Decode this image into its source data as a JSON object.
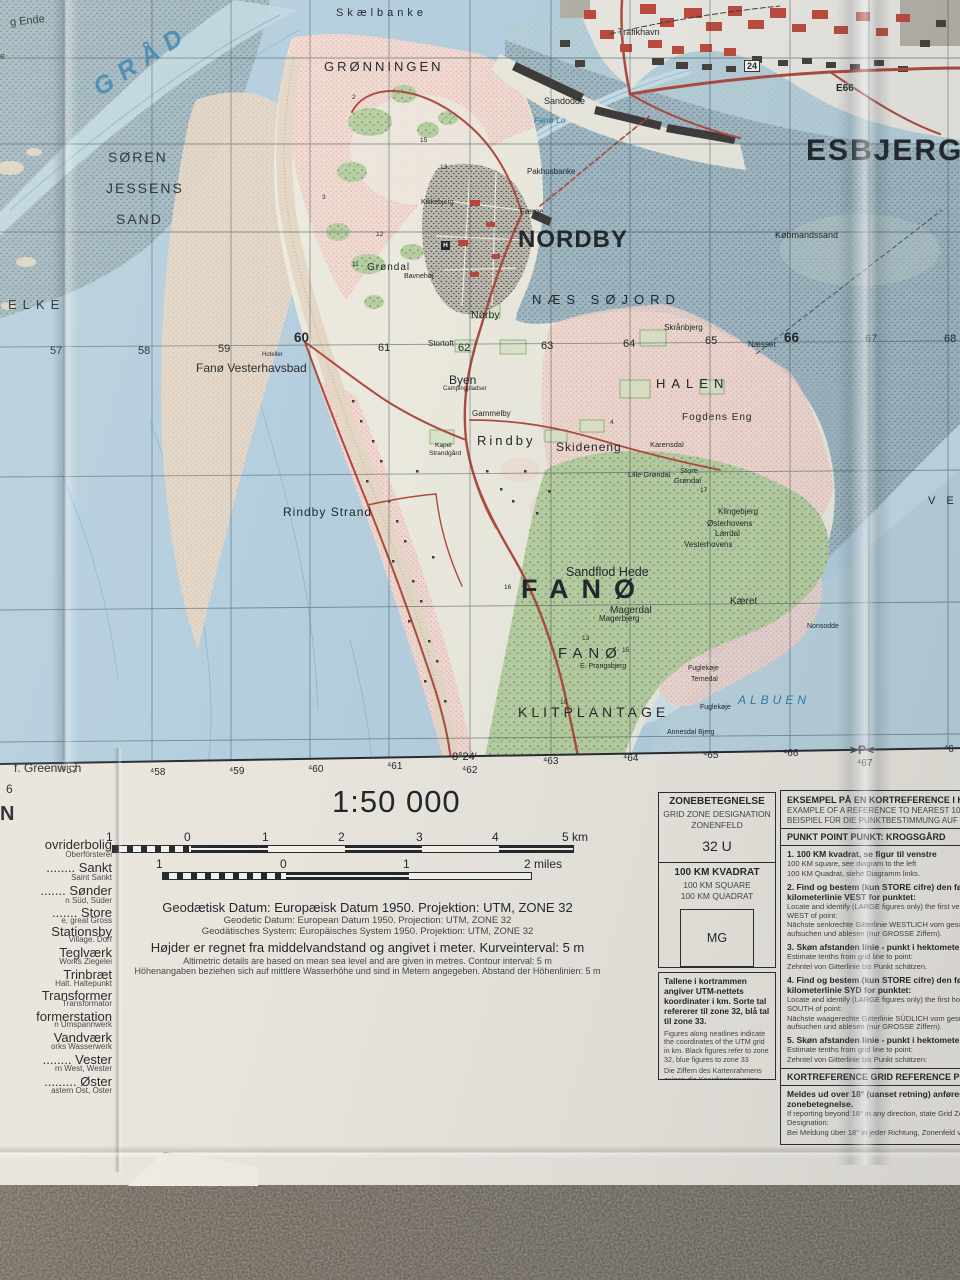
{
  "map_labels": {
    "g_ende": "g Ende",
    "e_frag": "e",
    "graadyb": "GRÅD",
    "skaelbanke": "Skælbanke",
    "groenningen": "GRØNNINGEN",
    "soeren": "SØREN",
    "jessens": "JESSENS",
    "sand": "SAND",
    "esbjerg": "ESBJERG",
    "trafikhavn": "Trafikhavn",
    "sandodde": "Sandodde",
    "fanoe_lo": "Fanø Lo",
    "pakhusbanke": "Pakhusbanke",
    "faerge": "Færge",
    "e66": "E66",
    "road24": "24",
    "koebmandssand": "Købmandssand",
    "nordby": "NORDBY",
    "naes_soejord": "NÆS SØJORD",
    "elke": "ELKE",
    "fanoe_vesterhavsbad": "Fanø Vesterhavsbad",
    "hoteller": "Hoteller",
    "skraanbjerg": "Skrånbjerg",
    "naesset": "Næsset",
    "halen": "HALEN",
    "fogdens_eng": "Fogdens Eng",
    "byen": "Byen",
    "stortoft": "Stortoft",
    "campingpladser": "Campingpladser",
    "gammelby": "Gammelby",
    "rindby": "Rindby",
    "skideneng": "Skideneng",
    "karensdal": "Karensdal",
    "lille_groendal": "Lille Grøndal",
    "store_groendal_1": "Store",
    "store_groendal_2": "Grøndal",
    "groendal": "Grøndal",
    "bavnehoej": "Bavnehøj",
    "kikkebjerg": "Kikkebjerg",
    "noerby": "Nørby",
    "kapel": "Kapel",
    "strandgaard": "Strandgård",
    "rindby_strand": "Rindby Strand",
    "klingebjerg": "Klingebjerg",
    "oesterhovens": "Østerhovens",
    "laerdal": "Lærdal",
    "vesterhovens": "Vesterhovens",
    "sandflod_hede": "Sandflod Hede",
    "fanoe_big": "FANØ",
    "magerdal": "Magerdal",
    "magerbjerg": "Magerbjerg",
    "kaeret": "Kæret",
    "nonsodde": "Nonsodde",
    "fanoe_small": "FANØ",
    "prangsbjerg": "E. Prangsbjerg",
    "klitplantage": "KLITPLANTAGE",
    "fuglekoeje1": "Fuglekøje",
    "ternedal": "Ternedal",
    "fuglekoeje2": "Fuglekøje",
    "annesdal_bjerg": "Annesdal Bjerg",
    "albuen": "ALBUEN",
    "ve_partial": "V E",
    "hospital_h": "H"
  },
  "grid_numbers": {
    "n57": "57",
    "n58": "58",
    "n59": "59",
    "n60": "60",
    "n61": "61",
    "n62": "62",
    "n63": "63",
    "n64": "64",
    "n65": "65",
    "n66": "66",
    "n67": "67",
    "n68": "68"
  },
  "margin": {
    "greenwich": "f. Greenwich",
    "frag_6": "6",
    "frag_n": "N",
    "m457": "⁴57",
    "m458": "⁴58",
    "m459": "⁴59",
    "m460": "⁴60",
    "m461": "⁴61",
    "deg": "8°24′",
    "m462": "⁴62",
    "m463": "⁴63",
    "m464": "⁴64",
    "m465": "⁴65",
    "m466": "⁴66",
    "p_mark": ">P<",
    "m467": "⁴67",
    "m468": "⁴6"
  },
  "spot_heights": {
    "s1": "2",
    "s2": "15",
    "s3": "13",
    "s4": "3",
    "s5": "12",
    "s6": "11",
    "s7": "4",
    "s8": "17",
    "s9": "13",
    "s10": "15",
    "s11": "16",
    "s12": "10"
  },
  "scale": {
    "ratio": "1:50 000",
    "km_m1": "1",
    "km_0": "0",
    "km_1": "1",
    "km_2": "2",
    "km_3": "3",
    "km_4": "4",
    "km_5": "5 km",
    "mi_m1": "1",
    "mi_0": "0",
    "mi_1": "1",
    "mi_2": "2 miles"
  },
  "notes": {
    "datum_da": "Geodætisk Datum: Europæisk Datum 1950.  Projektion: UTM, ZONE 32",
    "datum_en": "Geodetic Datum: European Datum 1950.  Projection: UTM, ZONE 32",
    "datum_de": "Geodätisches System: Europäisches System 1950.  Projektion: UTM, ZONE 32",
    "height_da": "Højder er regnet fra middelvandstand og angivet i meter.  Kurveinterval: 5 m",
    "height_en": "Altimetric details are based on mean sea level and are given in metres.  Contour interval: 5 m",
    "height_de": "Höhenangaben beziehen sich auf mittlere Wasserhöhe und sind in Metern angegeben.  Abstand der Höhenlinien: 5 m"
  },
  "zone_panel": {
    "title_da": "ZONEBETEGNELSE",
    "title_en": "GRID ZONE DESIGNATION",
    "title_de": "ZONENFELD",
    "value": "32 U",
    "square_da": "100 KM KVADRAT",
    "square_en": "100 KM SQUARE",
    "square_de": "100 KM QUADRAT",
    "square_id": "MG"
  },
  "numbers_panel": {
    "da": "Tallene i kortrammen angiver UTM-nettets koordinater i km. Sorte tal refererer til zone 32, blå tal til zone 33.",
    "en": "Figures along neatlines indicate the coordinates of the UTM grid in km. Black figures refer to zone 32, blue figures to zone 33",
    "de": "Die Ziffern des Kartenrahmens zeigen die Koordinatenwertes des UTM Gitters in km. Schwarze Ziffern verweisen an Zone 32, blaue Ziffern an Zone 33."
  },
  "ref_panel": {
    "title_da": "EKSEMPEL PÅ EN KORTREFERENCE I HEKTOMETER",
    "title_en": "EXAMPLE OF A REFERENCE TO NEAREST 100 METRES",
    "title_de": "BEISPIEL FÜR DIE PUNKTBESTIMMUNG AUF VOLLE 100 METER",
    "punkt_line": "PUNKT   POINT   PUNKT:   KROGSGÅRD",
    "i1_da": "1. 100 KM kvadrat, se figur til venstre",
    "i1_en": "100 KM square, see diagram to the left",
    "i1_de": "100 KM Quadrat, siehe Diagramm links.",
    "i2_da": "2. Find og bestem (kun STORE cifre) den første kilometerlinie VEST for punktet:",
    "i2_en": "Locate and identify (LARGE figures only) the first vertical grid line WEST of point:",
    "i2_de": "Nächste senkrechte Gitterlinie WESTLICH vom gesuchten Punkt aufsuchen und ablesen (nur GROSSE Ziffern).",
    "i3_da": "3. Skøn afstanden linie - punkt i hektometer:",
    "i3_en": "Estimate tenths from grid line to point:",
    "i3_de": "Zehntel von Gitterlinie bis Punkt schätzen.",
    "i4_da": "4. Find og bestem (kun STORE cifre) den første kilometerlinie SYD for punktet:",
    "i4_en": "Locate and identify (LARGE figures only) the first horizontal grid line SOUTH of point:",
    "i4_de": "Nächste waagerechte Gitterlinie SÜDLICH vom gesuchten Punkt aufsuchen und ablesen (nur GROSSE Ziffern).",
    "i5_da": "5. Skøn afstanden linie - punkt i hektometer:",
    "i5_en": "Estimate tenths from grid line to point:",
    "i5_de": "Zehntel von Gitterlinie bis Punkt schätzen:",
    "kortref_line": "KORTREFERENCE   GRID REFERENCE   PUNKTBESTIMMUNG",
    "meldes_da": "Meldes ud over 18° (uanset retning) anføres zonebetegnelse.",
    "meldes_en": "If reporting beyond 18° in any direction, state Grid Zone Designation:",
    "meldes_de": "Bei Meldung über 18° in jeder Richtung, Zonenfeld voransetzen."
  },
  "left_legend": {
    "e1_main": "ovriderbolig",
    "e1_sub": "Oberförsterei",
    "e2_main": "........ Sankt",
    "e2_sub": "Saint   Sankt",
    "e3_main": "....... Sønder",
    "e3_sub": "n   Süd, Süder",
    "e4_main": "....... Store",
    "e4_sub": "e, great   Gross",
    "e5_main": "Stationsby",
    "e5_sub": "Village.  Dorf",
    "e6_main": "Teglværk",
    "e6_sub": "Works   Ziegelei",
    "e7_main": "Trinbræt",
    "e7_sub": "Halt.   Haltepunkt",
    "e8_main": "Transformer",
    "e8_sub": "Transformator",
    "e9_main": "formerstation",
    "e9_sub": "n   Umspannwerk",
    "e10_main": "Vandværk",
    "e10_sub": "orks   Wasserwerk",
    "e11_main": "........ Vester",
    "e11_sub": "rn   West, Wester",
    "e12_main": "......... Øster",
    "e12_sub": "astern   Ost, Oster"
  },
  "colors": {
    "sea": "#b4cede",
    "tidal_flat": "#a1b7c1",
    "sand": "#e4d7c8",
    "dune_pink": "#f0d6cf",
    "forest_green": "#b7cea3",
    "road_red": "#ae4a3e",
    "water_label_blue": "#2f7fae"
  }
}
